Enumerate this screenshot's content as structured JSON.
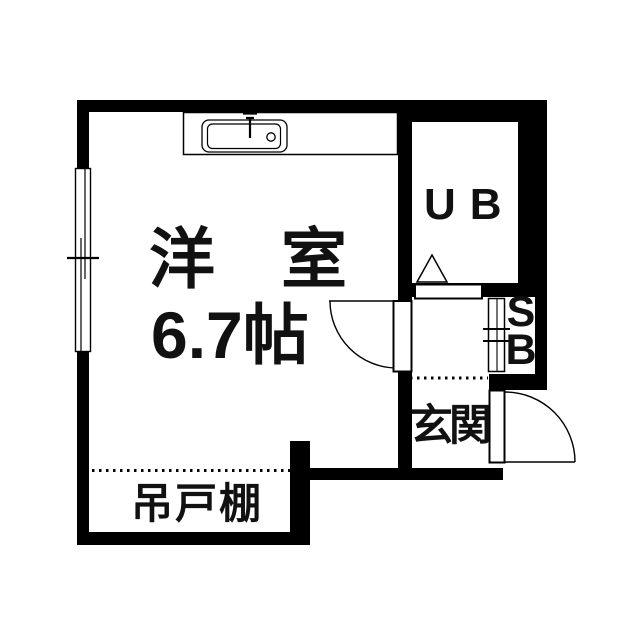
{
  "plan": {
    "type": "floor-plan",
    "background_color": "#ffffff",
    "wall_color": "#000000",
    "labels": {
      "main_room_name": "洋　室",
      "main_room_size": "6.7帖",
      "unit_bath": "UB",
      "shoe_box_line1": "S",
      "shoe_box_line2": "B",
      "entrance": "玄関",
      "hanging_cupboard": "吊戸棚"
    }
  }
}
